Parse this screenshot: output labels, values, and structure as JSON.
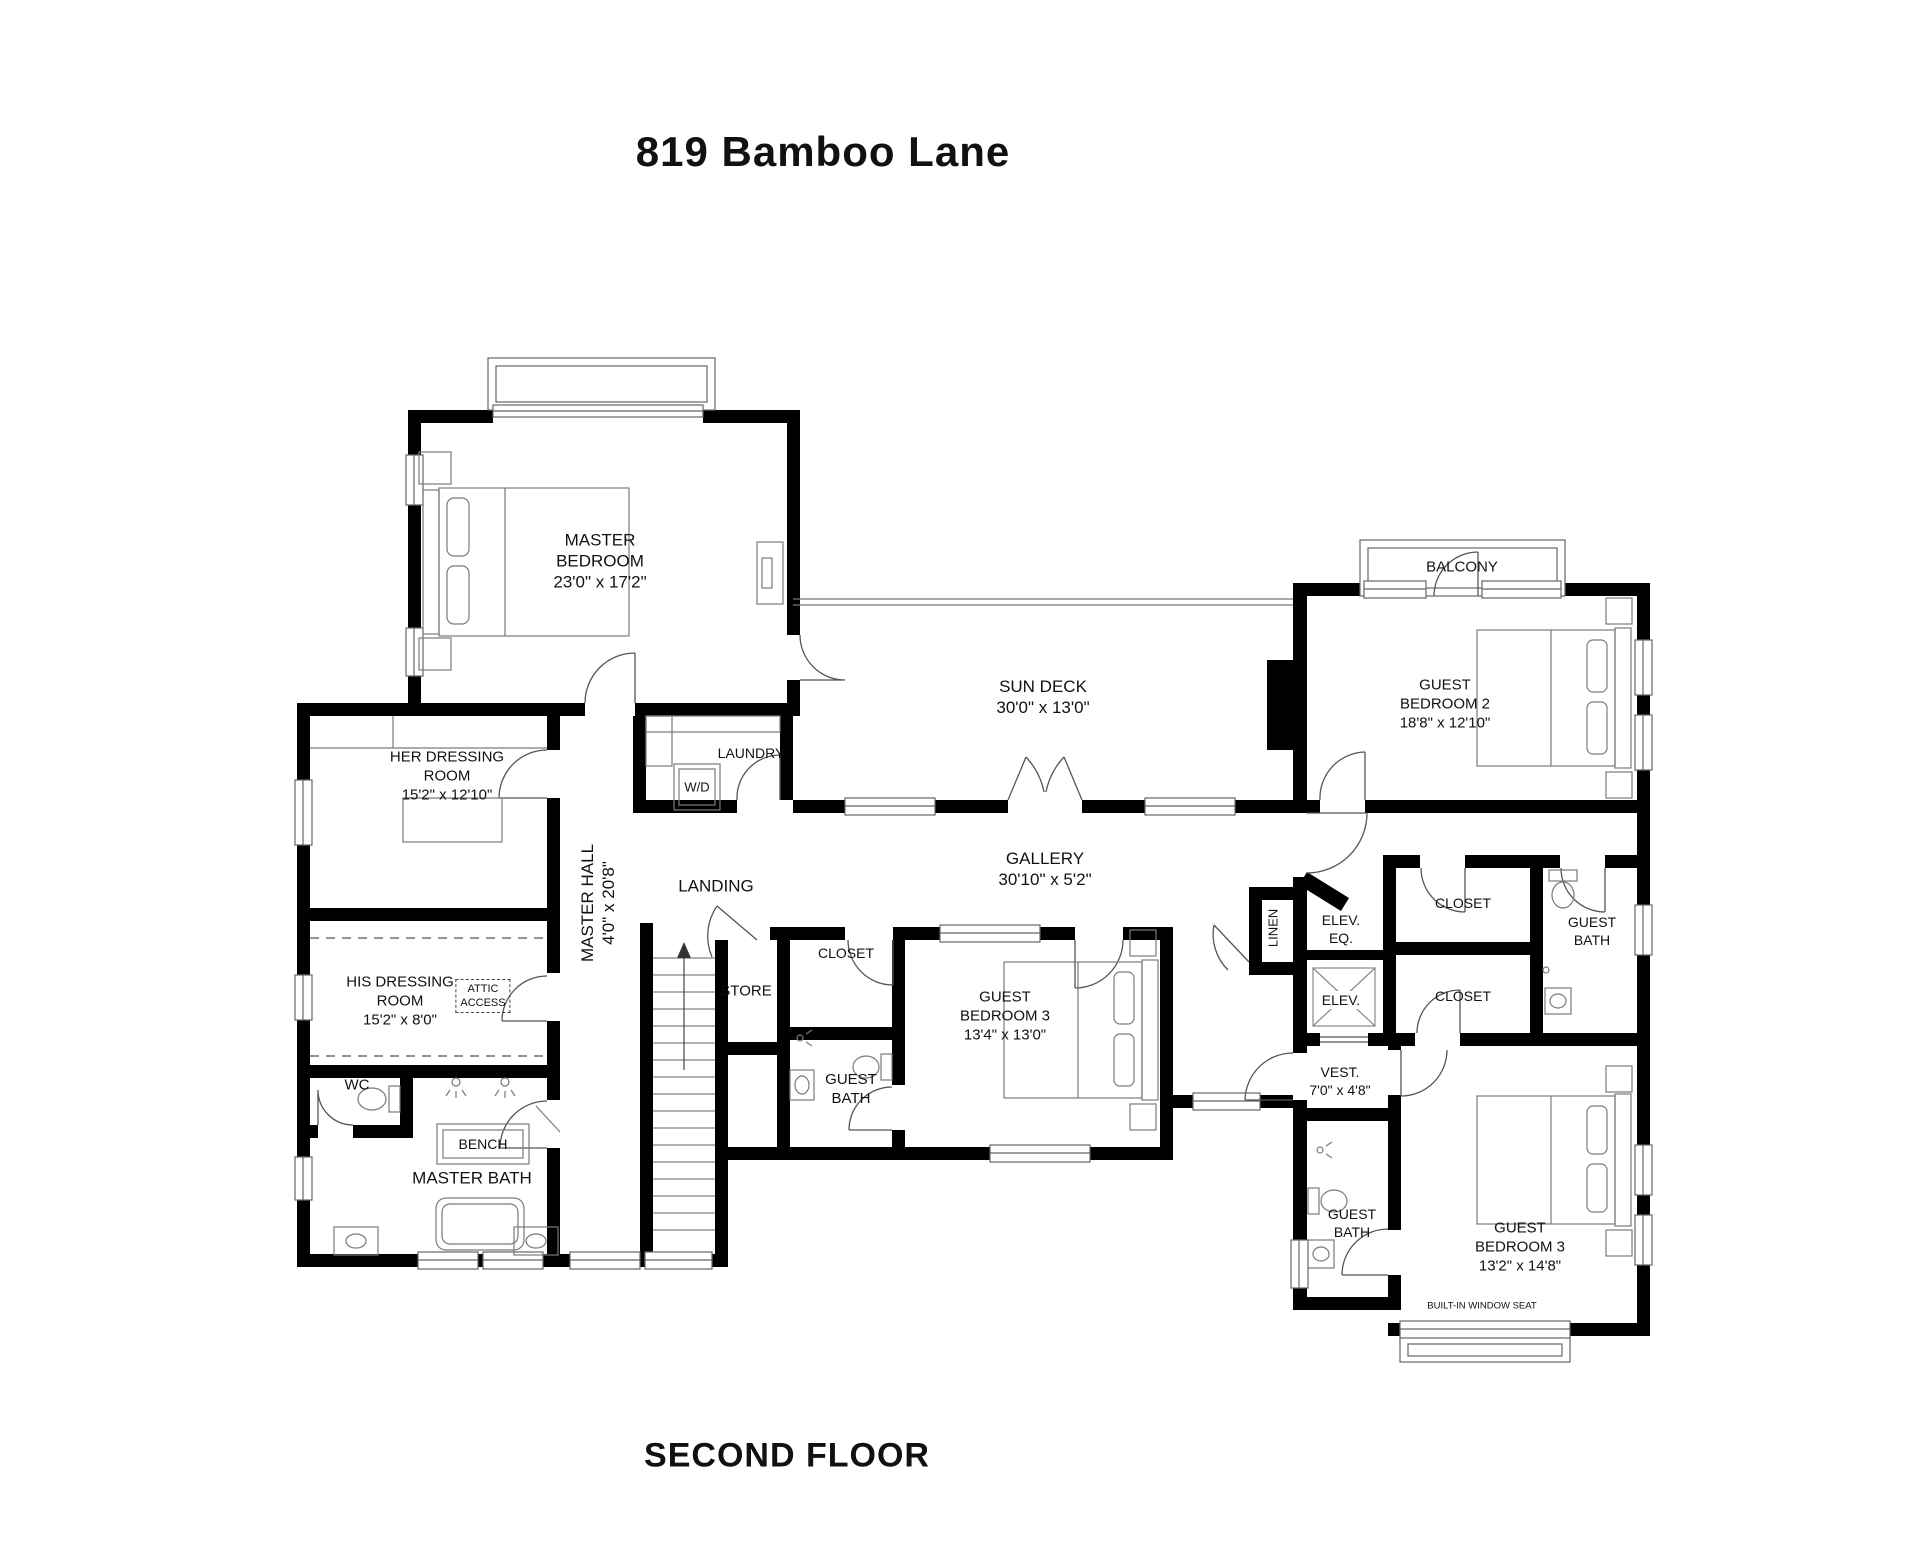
{
  "title": "819 Bamboo Lane",
  "floor_label": "SECOND FLOOR",
  "colors": {
    "wall": "#000000",
    "text": "#111111",
    "line": "#777777"
  },
  "rooms": {
    "master_bedroom": {
      "lines": [
        "MASTER",
        "BEDROOM",
        "23'0\" x 17'2\""
      ]
    },
    "her_dressing": {
      "lines": [
        "HER DRESSING",
        "ROOM",
        "15'2\" x 12'10\""
      ]
    },
    "his_dressing": {
      "lines": [
        "HIS DRESSING",
        "ROOM",
        "15'2\" x 8'0\""
      ]
    },
    "attic_access": {
      "lines": [
        "ATTIC",
        "ACCESS"
      ]
    },
    "master_hall": {
      "lines": [
        "MASTER HALL",
        "4'0\" x 20'8\""
      ]
    },
    "wc": {
      "lines": [
        "WC"
      ]
    },
    "bench": {
      "lines": [
        "BENCH"
      ]
    },
    "master_bath": {
      "lines": [
        "MASTER BATH"
      ]
    },
    "laundry": {
      "lines": [
        "LAUNDRY"
      ]
    },
    "wd": {
      "lines": [
        "W/D"
      ]
    },
    "landing": {
      "lines": [
        "LANDING"
      ]
    },
    "store": {
      "lines": [
        "STORE"
      ]
    },
    "sun_deck": {
      "lines": [
        "SUN DECK",
        "30'0\" x 13'0\""
      ]
    },
    "gallery": {
      "lines": [
        "GALLERY",
        "30'10\" x 5'2\""
      ]
    },
    "closet_mid": {
      "lines": [
        "CLOSET"
      ]
    },
    "guest_bath_mid": {
      "lines": [
        "GUEST",
        "BATH"
      ]
    },
    "guest_bedroom3_mid": {
      "lines": [
        "GUEST",
        "BEDROOM 3",
        "13'4\" x 13'0\""
      ]
    },
    "balcony": {
      "lines": [
        "BALCONY"
      ]
    },
    "guest_bedroom2": {
      "lines": [
        "GUEST",
        "BEDROOM 2",
        "18'8\" x 12'10\""
      ]
    },
    "closet_right_upper": {
      "lines": [
        "CLOSET"
      ]
    },
    "guest_bath_right": {
      "lines": [
        "GUEST",
        "BATH"
      ]
    },
    "linen": {
      "lines": [
        "LINEN"
      ]
    },
    "elev_eq": {
      "lines": [
        "ELEV.",
        "EQ."
      ]
    },
    "elev": {
      "lines": [
        "ELEV."
      ]
    },
    "closet_right_lower": {
      "lines": [
        "CLOSET"
      ]
    },
    "vest": {
      "lines": [
        "VEST.",
        "7'0\" x 4'8\""
      ]
    },
    "guest_bath_br": {
      "lines": [
        "GUEST",
        "BATH"
      ]
    },
    "guest_bedroom3_right": {
      "lines": [
        "GUEST",
        "BEDROOM 3",
        "13'2\" x 14'8\""
      ]
    },
    "window_seat": {
      "lines": [
        "BUILT-IN WINDOW SEAT"
      ]
    }
  }
}
